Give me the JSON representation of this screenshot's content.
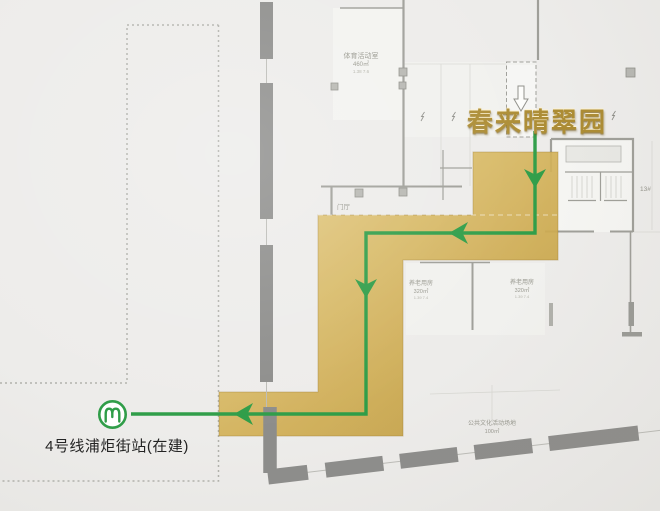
{
  "map": {
    "destination": {
      "title": "春来晴翠园"
    },
    "station": {
      "label": "4号线浦炬街站(在建)",
      "icon": "shanghai-metro-logo"
    },
    "rooms": {
      "sports": {
        "name": "体育活动室",
        "area": "460㎡",
        "note": "1.38 7.6"
      },
      "elderly_left": {
        "name": "养老用房",
        "area": "320㎡",
        "note": "1.39 7.4"
      },
      "elderly_right": {
        "name": "养老用房",
        "area": "320㎡",
        "note": "1.39 7.4"
      },
      "public_ground": {
        "name": "公共文化活动场地",
        "area": "100㎡"
      },
      "lobby": {
        "name": "门厅"
      },
      "building_no": {
        "name": "13#"
      }
    },
    "colors": {
      "background": "#edecea",
      "route_green": "#2f9d48",
      "path_gold": "#d3b158",
      "road_gray": "#8d8d8b",
      "title_gold": "#ac8c34",
      "label_gray": "#98988f"
    }
  }
}
